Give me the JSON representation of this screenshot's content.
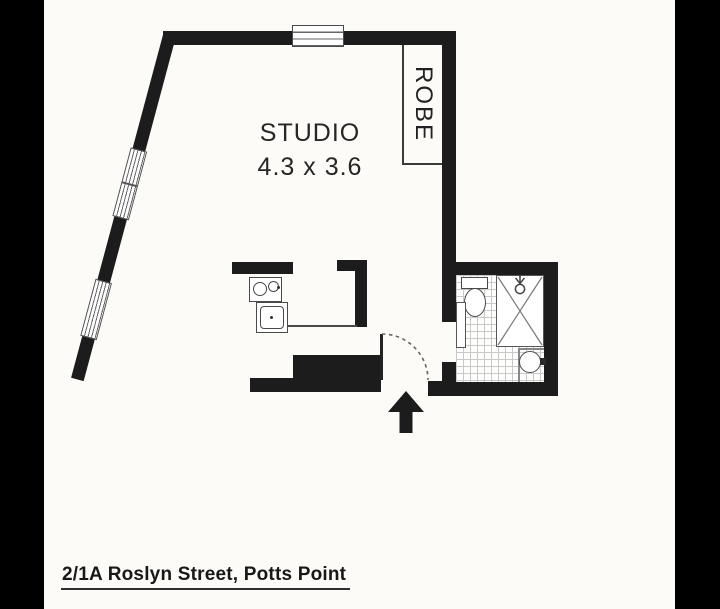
{
  "plan": {
    "room_label": "STUDIO",
    "room_dimensions": "4.3 x 3.6",
    "robe_label": "ROBE"
  },
  "footer": {
    "address": "2/1A Roslyn Street, Potts Point"
  },
  "icons": {
    "entry_arrow": "up-arrow",
    "shower_head": "shower-rose",
    "door_swing": "quarter-arc-dashed"
  },
  "colors": {
    "letterbox": "#000000",
    "paper": "#fcfbf7",
    "wall": "#1c1c1c",
    "thin_line": "#4a4a4a",
    "tile_line": "#c9c9c9"
  }
}
